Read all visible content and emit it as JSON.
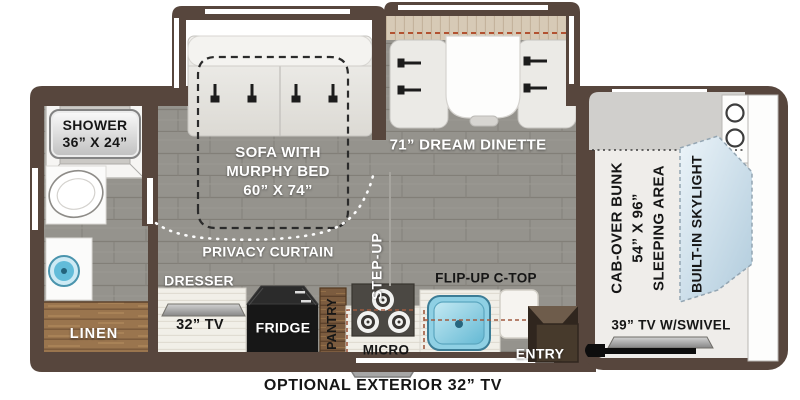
{
  "floorplan": {
    "labels": {
      "shower_line1": "SHOWER",
      "shower_line2": "36” X 24”",
      "sofa_line1": "SOFA WITH",
      "sofa_line2": "MURPHY BED",
      "sofa_line3": "60” X 74”",
      "dinette": "71” DREAM DINETTE",
      "privacy_curtain": "PRIVACY CURTAIN",
      "step_up": "STEP-UP",
      "dresser": "DRESSER",
      "tv_32": "32” TV",
      "fridge": "FRIDGE",
      "pantry": "PANTRY",
      "micro": "MICRO",
      "flip_up": "FLIP-UP C-TOP",
      "entry": "ENTRY",
      "linen": "LINEN",
      "cab_line1": "CAB-OVER BUNK",
      "cab_line2": "54” X 96”",
      "cab_line3": "SLEEPING AREA",
      "skylight": "BUILT-IN SKYLIGHT",
      "tv_39": "39” TV W/SWIVEL",
      "optional_tv": "OPTIONAL EXTERIOR 32” TV"
    },
    "colors": {
      "wall": "#57463d",
      "floor": "#95938d",
      "wood_light": "#9a754e",
      "wood_dark": "#6e523a",
      "accent_dash": "#b25231",
      "sink_blue": "#62bcd9",
      "skylight_blue": "#bfd6e4"
    }
  }
}
